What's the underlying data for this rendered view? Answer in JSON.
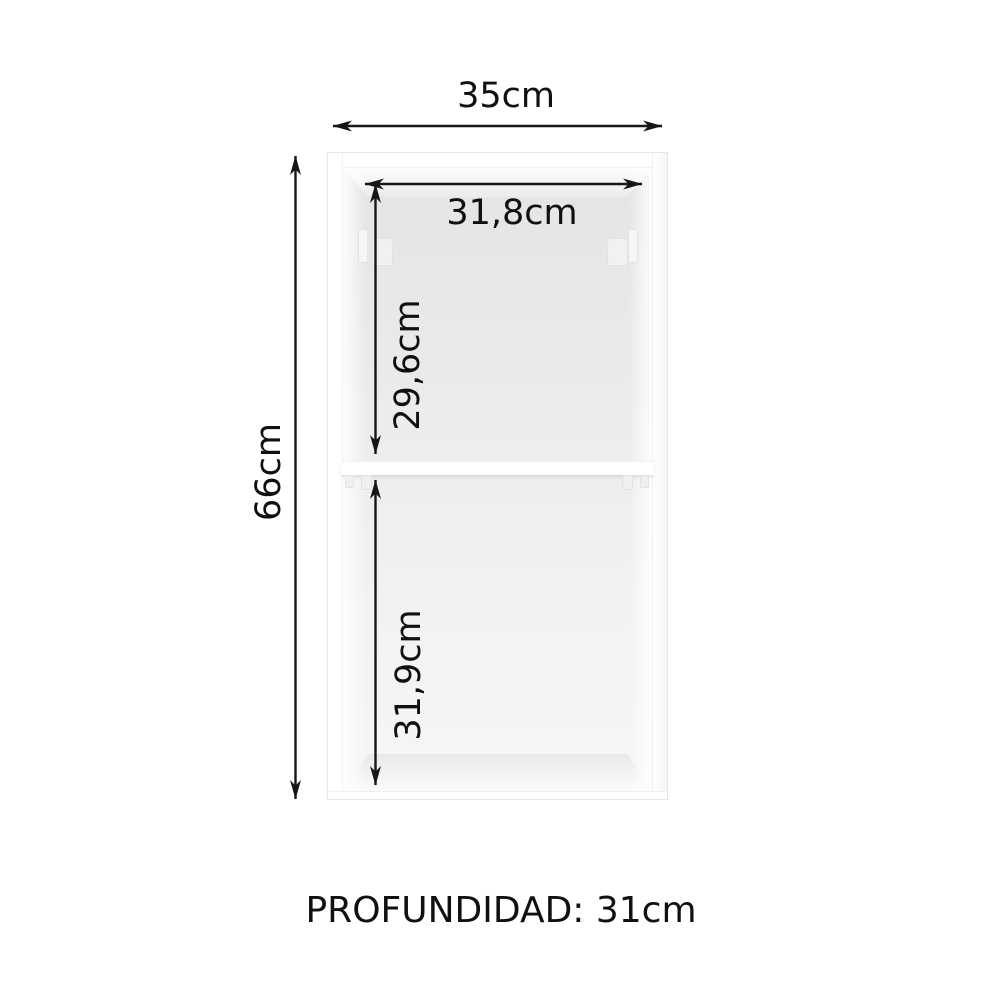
{
  "diagram": {
    "dimensions": {
      "outer_width": "35cm",
      "inner_width": "31,8cm",
      "upper_inner_height": "29,6cm",
      "lower_inner_height": "31,9cm",
      "total_height": "66cm"
    },
    "depth_text": "PROFUNDIDAD: 31cm",
    "colors": {
      "arrow": "#161616",
      "label_text": "#101010",
      "cabinet_face": "#ffffff",
      "cabinet_interior": "#ebebeb",
      "cabinet_outline": "#e7e7e7",
      "background": "#ffffff"
    }
  }
}
